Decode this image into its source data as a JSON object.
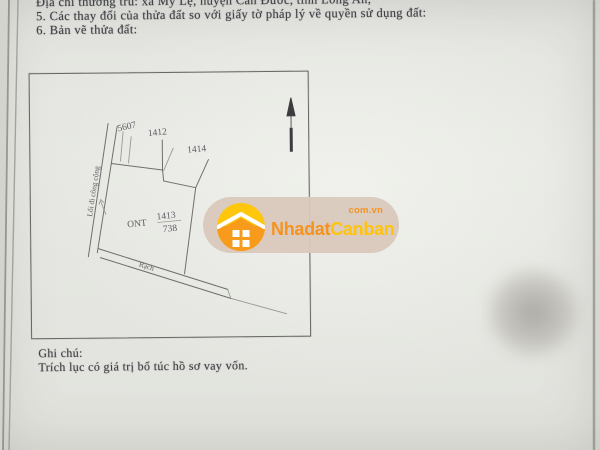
{
  "page": {
    "header_lines": [
      "Địa chỉ thường trú: xã Mỹ Lệ, huyện Cần Đước, tỉnh Long An;",
      "5. Các thay đổi của thửa đất so với giấy tờ pháp lý về quyền sử dụng đất:",
      "6. Bản vẽ thửa đất:"
    ],
    "notes_label": "Ghi chú:",
    "notes_text": "Trích lục có giá trị bổ túc hồ sơ vay vốn."
  },
  "map": {
    "adjacent_parcels": {
      "left_top": "5607",
      "top": "1412",
      "right_top": "1414"
    },
    "main_parcel": {
      "land_use": "ONT",
      "parcel_number": "1413",
      "area": "738"
    },
    "road_label": "Lối đi công cộng",
    "canal_label": "Rạch"
  },
  "watermark": {
    "brand_primary": "Nhadat",
    "brand_secondary": "Canban",
    "domain_suffix": "com.vn",
    "colors": {
      "orange": "#F6921E",
      "gold": "#FFC30B",
      "pill_background": "#D9C9BB",
      "logo_yellow": "#FFC60B",
      "logo_orange": "#F89B1C"
    }
  }
}
